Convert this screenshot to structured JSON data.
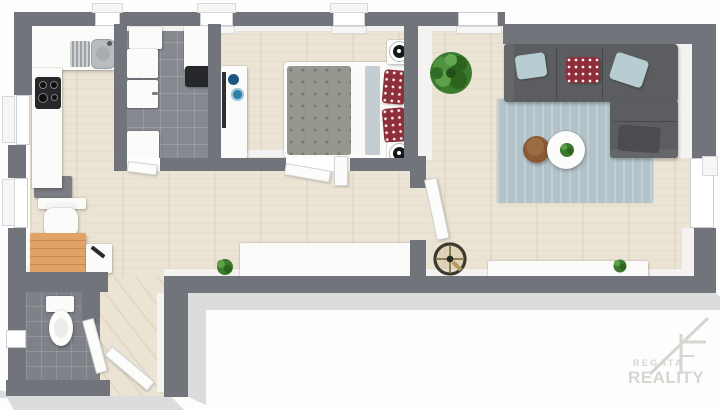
{
  "meta": {
    "kind": "3d-floor-plan-render",
    "width_px": 720,
    "height_px": 410
  },
  "watermark": {
    "brand_top": "REGATA",
    "brand_bottom": "REALITY",
    "logo": "house-roof-icon"
  },
  "rooms": [
    {
      "name": "kitchen"
    },
    {
      "name": "bathroom"
    },
    {
      "name": "bedroom"
    },
    {
      "name": "living-room"
    },
    {
      "name": "hallway"
    },
    {
      "name": "home-office-nook"
    },
    {
      "name": "wc"
    },
    {
      "name": "entry"
    }
  ],
  "furniture": {
    "kitchen": [
      "kitchen-counter",
      "kitchen-sink",
      "dish-rack",
      "induction-cooktop",
      "refrigerator",
      "radiator"
    ],
    "bathroom": [
      "bathroom-cabinet",
      "washing-machine",
      "washbasin",
      "countertop-unit",
      "dark-counter-appliance",
      "bathroom-door"
    ],
    "bedroom": [
      "wardrobe-dresser",
      "blue-deco-bowls",
      "double-bed",
      "speckled-duvet",
      "polka-dot-pillows",
      "folded-throw",
      "bedside-tables",
      "round-bedside-lamps",
      "bedroom-door"
    ],
    "living_room": [
      "corner-sofa",
      "blue-throw-pillows",
      "red-polka-pillow",
      "chaise-cushion",
      "area-rug",
      "round-coffee-table",
      "table-plant",
      "round-side-table",
      "large-potted-plant",
      "sideboard",
      "sideboard-plant",
      "pedestal-fan",
      "living-room-door"
    ],
    "office_nook": [
      "wooden-desk",
      "office-chair",
      "side-cabinet",
      "laptop"
    ],
    "wc": [
      "toilet",
      "wc-door"
    ],
    "hallway": [
      "hall-sideboard",
      "houseplant",
      "entrance-door",
      "open-door-panel"
    ]
  },
  "colors": {
    "bg": "#fdfdfd",
    "wall": "#71747b",
    "wall_inner": "#f4f3f1",
    "shadow": "#dbdcdd",
    "floor_wood": "#ebe3d3",
    "tile": "#868a90",
    "tile_wc": "#7e8288",
    "rug": "#b3c3ca",
    "sofa": "#5b5d61",
    "sofa_dark": "#4a4c50",
    "sofa_light": "#64666a",
    "duvet": "#98978f",
    "pillow_red": "#8e2e3a",
    "pillow_blue": "#b8cdd2",
    "plant": "#3a7a2c",
    "desk_wood": "#e0a365",
    "table_brown": "#8a5a35",
    "door": "#fcfcfb",
    "appliance_dark": "#26272a",
    "metal": "#b9bcbf",
    "deco_blue": "#2d7fa8",
    "deco_blue_dark": "#1f5580",
    "watermark": "#d6d6d0"
  }
}
